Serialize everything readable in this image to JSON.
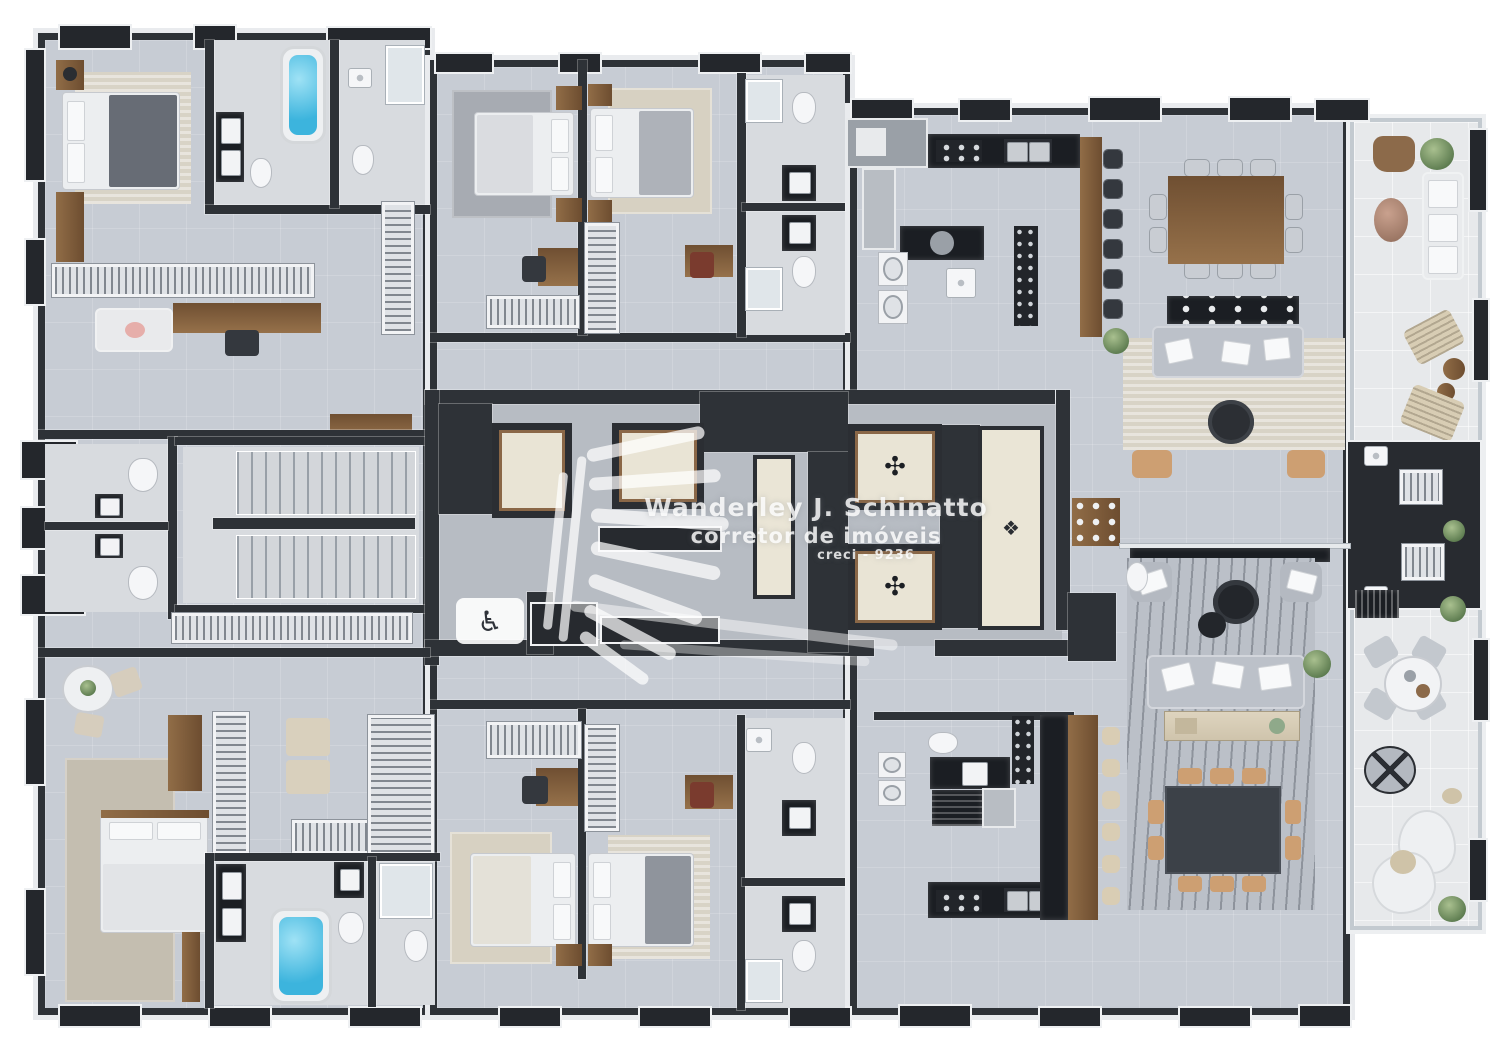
{
  "watermark": {
    "name": "Wanderley J. Schinatto",
    "role": "corretor de imóveis",
    "license": "creci - 9236"
  },
  "icons": {
    "wheelchair": "♿",
    "elevator_medallion": "✣",
    "hall_motif": "❖"
  },
  "palette": {
    "page_background": "#ffffff",
    "floor_tile": "#c7ccd4",
    "bathroom_floor": "#d8dbdf",
    "balcony_floor": "#e7e9eb",
    "wall_dark": "#2e3237",
    "marble_trim": "#e9ebee",
    "wood": "#7d5c3c",
    "black_marble_counter": "#1b1e23",
    "bathtub_water": "#3cb4dd",
    "rug_beige": "#d7d1c2",
    "rug_gray": "#a7abb2",
    "sofa_gray": "#bcc1c9",
    "chair_tan": "#cd9f72",
    "elevator_floor": "#e9e4d5"
  }
}
